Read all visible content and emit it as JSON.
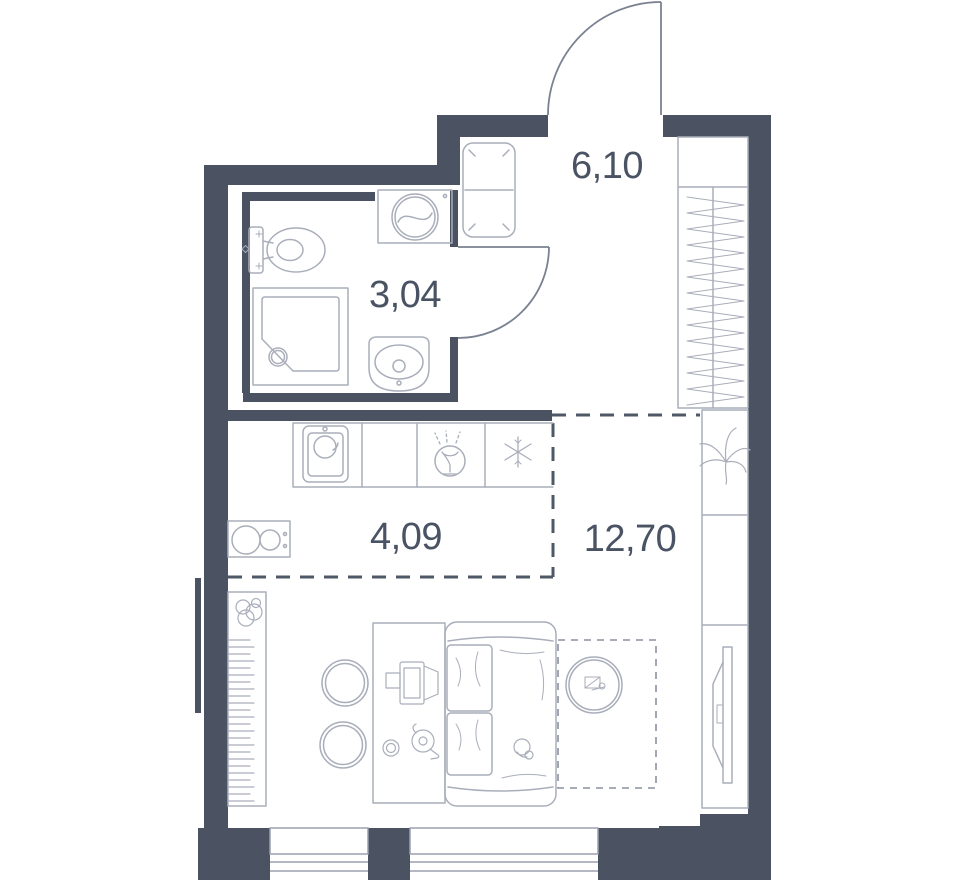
{
  "rooms": [
    {
      "name": "hallway",
      "area_label": "6,10"
    },
    {
      "name": "bathroom",
      "area_label": "3,04"
    },
    {
      "name": "kitchen",
      "area_label": "4,09"
    },
    {
      "name": "living_room",
      "area_label": "12,70"
    }
  ],
  "colors": {
    "wall": "#4b5362",
    "fixtures": "#a9aeba",
    "doors": "#7a8191",
    "dashed_zone": "#4f5866",
    "dashed_rug": "#8a90a0",
    "labels": "#4a5363",
    "background": "#ffffff"
  },
  "fixtures": [
    "entry-door",
    "bathroom-door",
    "hall-bench",
    "hall-wardrobe",
    "toilet",
    "washing-machine",
    "shower-cabin",
    "washbasin",
    "kitchen-counter",
    "kitchen-sink",
    "dishwasher",
    "fridge",
    "stove",
    "radiator-shelf",
    "plant",
    "round-table",
    "desk",
    "laptop",
    "cup",
    "kettle",
    "sofa-bed",
    "toy",
    "round-rug",
    "rug-zone",
    "storage-column",
    "tv-console",
    "tv",
    "window"
  ]
}
